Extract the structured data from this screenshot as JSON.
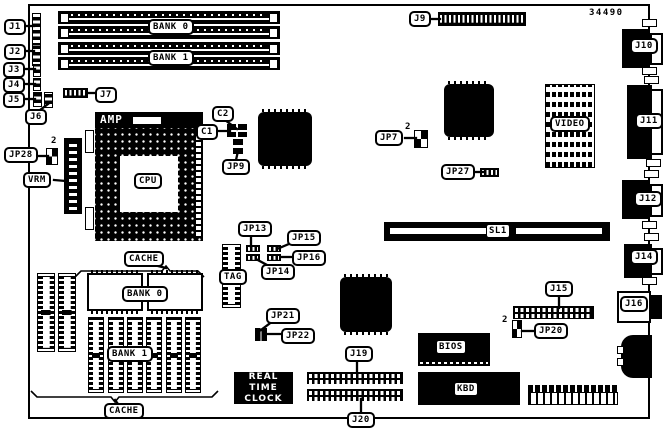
{
  "part_number": "34490",
  "connectors": {
    "j1": "J1",
    "j2": "J2",
    "j3": "J3",
    "j4": "J4",
    "j5": "J5",
    "j6": "J6",
    "j7": "J7",
    "j9": "J9",
    "j10": "J10",
    "j11": "J11",
    "j12": "J12",
    "j14": "J14",
    "j15": "J15",
    "j16": "J16",
    "j19": "J19",
    "j20": "J20",
    "sl1": "SL1"
  },
  "jumpers": {
    "jp7": "JP7",
    "jp9": "JP9",
    "jp13": "JP13",
    "jp14": "JP14",
    "jp15": "JP15",
    "jp16": "JP16",
    "jp20": "JP20",
    "jp21": "JP21",
    "jp22": "JP22",
    "jp27": "JP27",
    "jp28": "JP28",
    "pin2_marker": "2"
  },
  "capacitors": {
    "c1": "C1",
    "c2": "C2"
  },
  "chips": {
    "cpu": "CPU",
    "cpu_socket_brand": "AMP",
    "vrm": "VRM",
    "tag": "TAG",
    "video": "VIDEO",
    "bios": "BIOS",
    "kbd": "KBD",
    "rtc_line1": "REAL TIME",
    "rtc_line2": "CLOCK"
  },
  "memory": {
    "bank0": "BANK 0",
    "bank1": "BANK 1",
    "cache": "CACHE"
  }
}
